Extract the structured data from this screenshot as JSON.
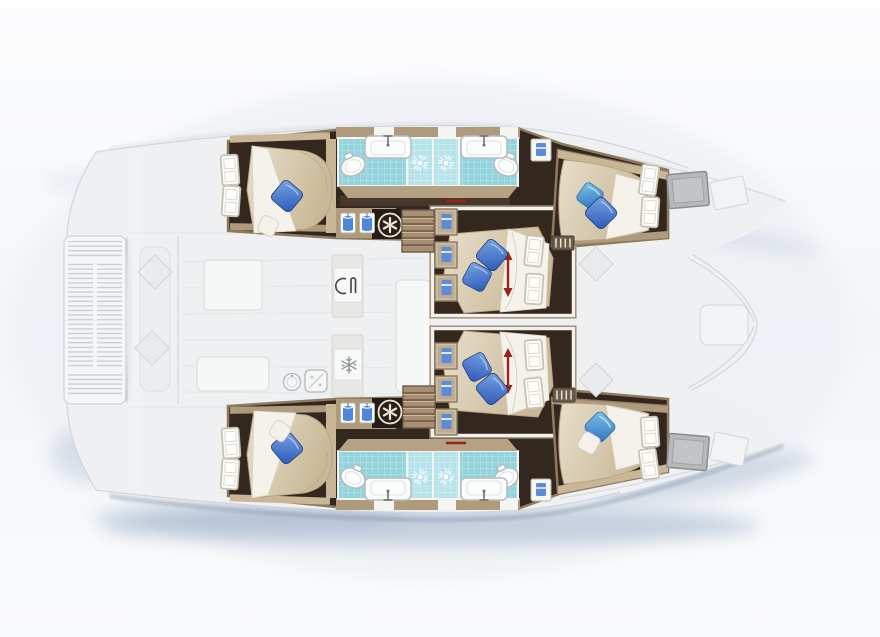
{
  "meta": {
    "title": "Catamaran interior layout floor plan",
    "view": "top-down",
    "bow_direction": "right",
    "visible_text": []
  },
  "colors": {
    "floorDark": "#33271e",
    "floorSoft": "#4a3a2b",
    "wood": "#af9a7b",
    "woodLight": "#c9b697",
    "woodDark": "#7d6a52",
    "bedBase": "#e2d7c0",
    "bedShade": "#b7a587",
    "sheet": "#f4f2ea",
    "sheetShade": "#d7d3c6",
    "pillowBlueDark": "#2a58b8",
    "pillowBlueHi": "#7aa5e4",
    "pillowCyan": "#7cc4e8",
    "pillowCyanDeep": "#2f6fc0",
    "pillowWhite": "#f3f1ea",
    "tile": "#93d3db",
    "tileLight": "#b5e3e9",
    "fixture": "#fbfcfc",
    "fixtureStroke": "#b6bcc0",
    "fixtureInner": "#dde0e2",
    "wallWhite": "#f2f0e9",
    "deckFaded": "#eef0f2",
    "deckStroke": "#d2d6da",
    "furniture": "#f6f7f7",
    "furnStroke": "#dcdfe1",
    "bench": "#ebedef",
    "shadowBlue": "#9dafc8",
    "accentRed": "#992317",
    "shirtBlue": "#4f86d8",
    "towelBlue": "#5c8cd8",
    "hatchGray": "#b6b8b9",
    "washerDark": "#2a211b",
    "washerCream": "#efe7d8"
  },
  "rooms": [
    {
      "id": "port-aft-cabin",
      "features": [
        "double-bed",
        "blue-pillow",
        "white-pillow",
        "hull-windows"
      ]
    },
    {
      "id": "port-head",
      "features": [
        "toilet",
        "sink",
        "shower"
      ]
    },
    {
      "id": "port-mid-cabin",
      "features": [
        "double-bed",
        "two-blue-pillows",
        "sliding-bed-arrow",
        "wardrobe-cubbies"
      ]
    },
    {
      "id": "port-forward-cabin",
      "features": [
        "double-bed",
        "two-blue-pillows",
        "hull-windows"
      ]
    },
    {
      "id": "starboard-aft-cabin",
      "features": [
        "double-bed",
        "blue-pillow",
        "white-pillow",
        "hull-windows"
      ]
    },
    {
      "id": "starboard-head",
      "features": [
        "toilet",
        "sink",
        "shower"
      ]
    },
    {
      "id": "starboard-mid-cabin",
      "features": [
        "double-bed",
        "two-blue-pillows",
        "sliding-bed-arrow",
        "wardrobe-cubbies"
      ]
    },
    {
      "id": "starboard-forward-cabin",
      "features": [
        "double-bed",
        "blue-pillow",
        "white-pillow",
        "hull-windows"
      ]
    },
    {
      "id": "saloon-galley",
      "features": [
        "cooktop-icon",
        "fridge-snowflake-icon",
        "round-sink",
        "stove",
        "tables"
      ]
    },
    {
      "id": "aft-cockpit",
      "features": [
        "bench",
        "cushions",
        "tables"
      ]
    },
    {
      "id": "stern-platform",
      "features": [
        "teak-slats"
      ]
    },
    {
      "id": "foredeck",
      "features": [
        "deck-hatches",
        "forward-cockpit-seat"
      ]
    }
  ],
  "sprites": {
    "suns": [
      [
        420,
        163
      ],
      [
        446,
        163
      ],
      [
        420,
        477
      ],
      [
        446,
        477
      ]
    ],
    "toilets": [
      [
        353,
        166,
        -25
      ],
      [
        506,
        166,
        25
      ],
      [
        353,
        478,
        25
      ],
      [
        506,
        478,
        -25
      ]
    ],
    "sinks": [
      [
        388,
        147,
        0
      ],
      [
        484,
        147,
        0
      ],
      [
        388,
        489,
        180
      ],
      [
        484,
        489,
        180
      ]
    ],
    "shirts": [
      [
        348,
        223,
        0
      ],
      [
        367,
        223,
        0
      ],
      [
        348,
        413,
        0
      ],
      [
        367,
        413,
        0
      ]
    ],
    "cubbies": [
      [
        446,
        222,
        0
      ],
      [
        446,
        255,
        0
      ],
      [
        446,
        288,
        0
      ],
      [
        446,
        356,
        0
      ],
      [
        446,
        389,
        0
      ],
      [
        446,
        422,
        0
      ]
    ],
    "towel_lockers": [
      [
        541,
        150,
        0
      ],
      [
        541,
        490,
        0
      ]
    ],
    "windows": [
      [
        230,
        170,
        -4
      ],
      [
        231,
        201,
        4
      ],
      [
        230,
        474,
        4
      ],
      [
        231,
        443,
        -4
      ],
      [
        649,
        180,
        8
      ],
      [
        650,
        212,
        4
      ],
      [
        650,
        432,
        -4
      ],
      [
        649,
        464,
        -8
      ],
      [
        534,
        251,
        6
      ],
      [
        534,
        289,
        4
      ],
      [
        534,
        355,
        -4
      ],
      [
        534,
        393,
        -6
      ]
    ],
    "washers": [
      [
        390,
        225,
        0
      ],
      [
        390,
        412,
        0
      ]
    ],
    "stairs": [
      [
        418,
        231,
        0
      ],
      [
        419,
        407,
        0
      ]
    ],
    "vents": [
      [
        563,
        243,
        0
      ],
      [
        564,
        395,
        0
      ]
    ],
    "hatches": [
      [
        688,
        190,
        -5
      ],
      [
        688,
        452,
        5
      ]
    ],
    "hatch_outlines": [
      [
        729,
        193,
        -12
      ],
      [
        729,
        449,
        12
      ]
    ],
    "arrows": [
      [
        508,
        274,
        0
      ],
      [
        508,
        371,
        0
      ]
    ],
    "red_ticks": [
      [
        456,
        201,
        0
      ],
      [
        456,
        443,
        0
      ]
    ],
    "deck_diamonds": [
      [
        155,
        272,
        0
      ],
      [
        152,
        348,
        0
      ],
      [
        596,
        264,
        0
      ],
      [
        596,
        380,
        0
      ]
    ],
    "pillows": [
      {
        "x": 287,
        "y": 196,
        "r": 40,
        "s": 1,
        "v": "blue"
      },
      {
        "x": 268,
        "y": 226,
        "r": 25,
        "s": 0.8,
        "v": "white"
      },
      {
        "x": 287,
        "y": 448,
        "r": 50,
        "s": 1,
        "v": "blue"
      },
      {
        "x": 280,
        "y": 431,
        "r": 35,
        "s": 0.8,
        "v": "white"
      },
      {
        "x": 492,
        "y": 255,
        "r": 40,
        "s": 1,
        "v": "blue"
      },
      {
        "x": 477,
        "y": 277,
        "r": 28,
        "s": 0.95,
        "v": "blue"
      },
      {
        "x": 492,
        "y": 389,
        "r": 50,
        "s": 1,
        "v": "blue"
      },
      {
        "x": 477,
        "y": 367,
        "r": 62,
        "s": 0.95,
        "v": "blue"
      },
      {
        "x": 590,
        "y": 196,
        "r": 35,
        "s": 0.9,
        "v": "light"
      },
      {
        "x": 601,
        "y": 213,
        "r": 45,
        "s": 1,
        "v": "blue"
      },
      {
        "x": 600,
        "y": 427,
        "r": 45,
        "s": 1,
        "v": "light"
      },
      {
        "x": 589,
        "y": 443,
        "r": 30,
        "s": 0.85,
        "v": "white"
      }
    ],
    "galley_icons": [
      {
        "t": "cook",
        "x": 348,
        "y": 286
      },
      {
        "t": "snow",
        "x": 349,
        "y": 365
      },
      {
        "t": "sinkround",
        "x": 292,
        "y": 382
      },
      {
        "t": "stove",
        "x": 316,
        "y": 381
      }
    ]
  }
}
